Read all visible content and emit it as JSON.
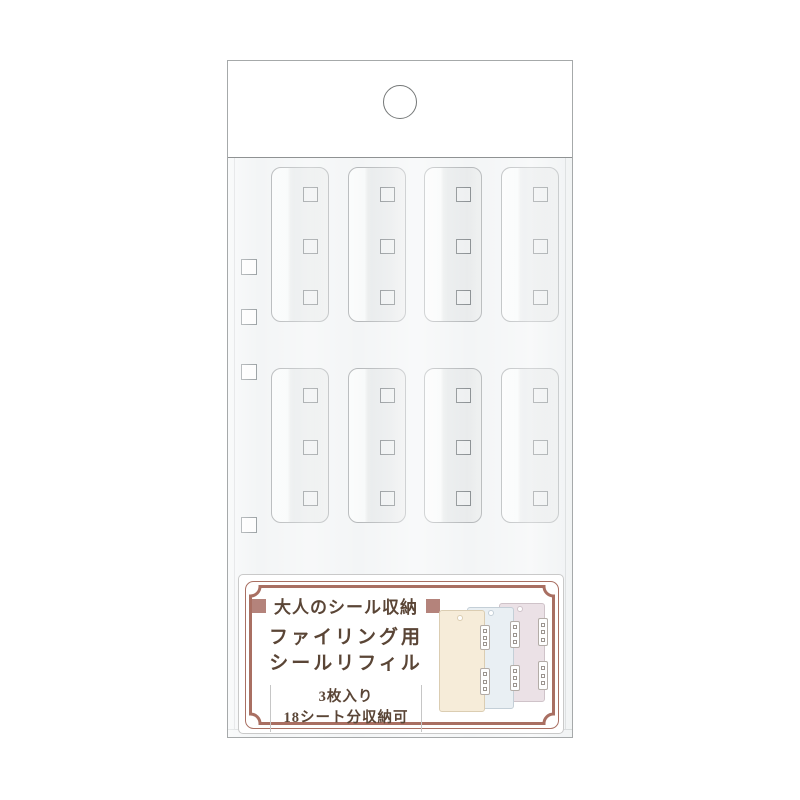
{
  "package": {
    "header_card": {
      "hang_hole_icon": "round-euro-hang-hole"
    },
    "bag": {
      "pocket_rows": 2,
      "pocket_cols": 4,
      "holes_per_pocket": 3,
      "binder_hole_count": 4
    },
    "label_card": {
      "title": "大人のシール収納",
      "product_name_line1": "ファイリング用",
      "product_name_line2": "シールリフィル",
      "spec_line1": "3枚入り",
      "spec_line2": "18シート分収納可"
    },
    "illustration": {
      "sheets": [
        {
          "name": "pink-refill-sheet",
          "fill": "#ebe1e6",
          "border": "#cfc3c9"
        },
        {
          "name": "blue-refill-sheet",
          "fill": "#e9eff3",
          "border": "#c4cfd7"
        },
        {
          "name": "cream-refill-sheet",
          "fill": "#f6ecd9",
          "border": "#dbcdb2"
        }
      ]
    },
    "colors": {
      "frame_brown": "#a96f62",
      "text_brown": "#5a4536",
      "accent_square": "#b4837b",
      "bag_tint": "#f3f5f6",
      "sheet_cream": "#f6ecd9",
      "sheet_blue": "#e9eff3",
      "sheet_pink": "#ebe1e6"
    }
  }
}
